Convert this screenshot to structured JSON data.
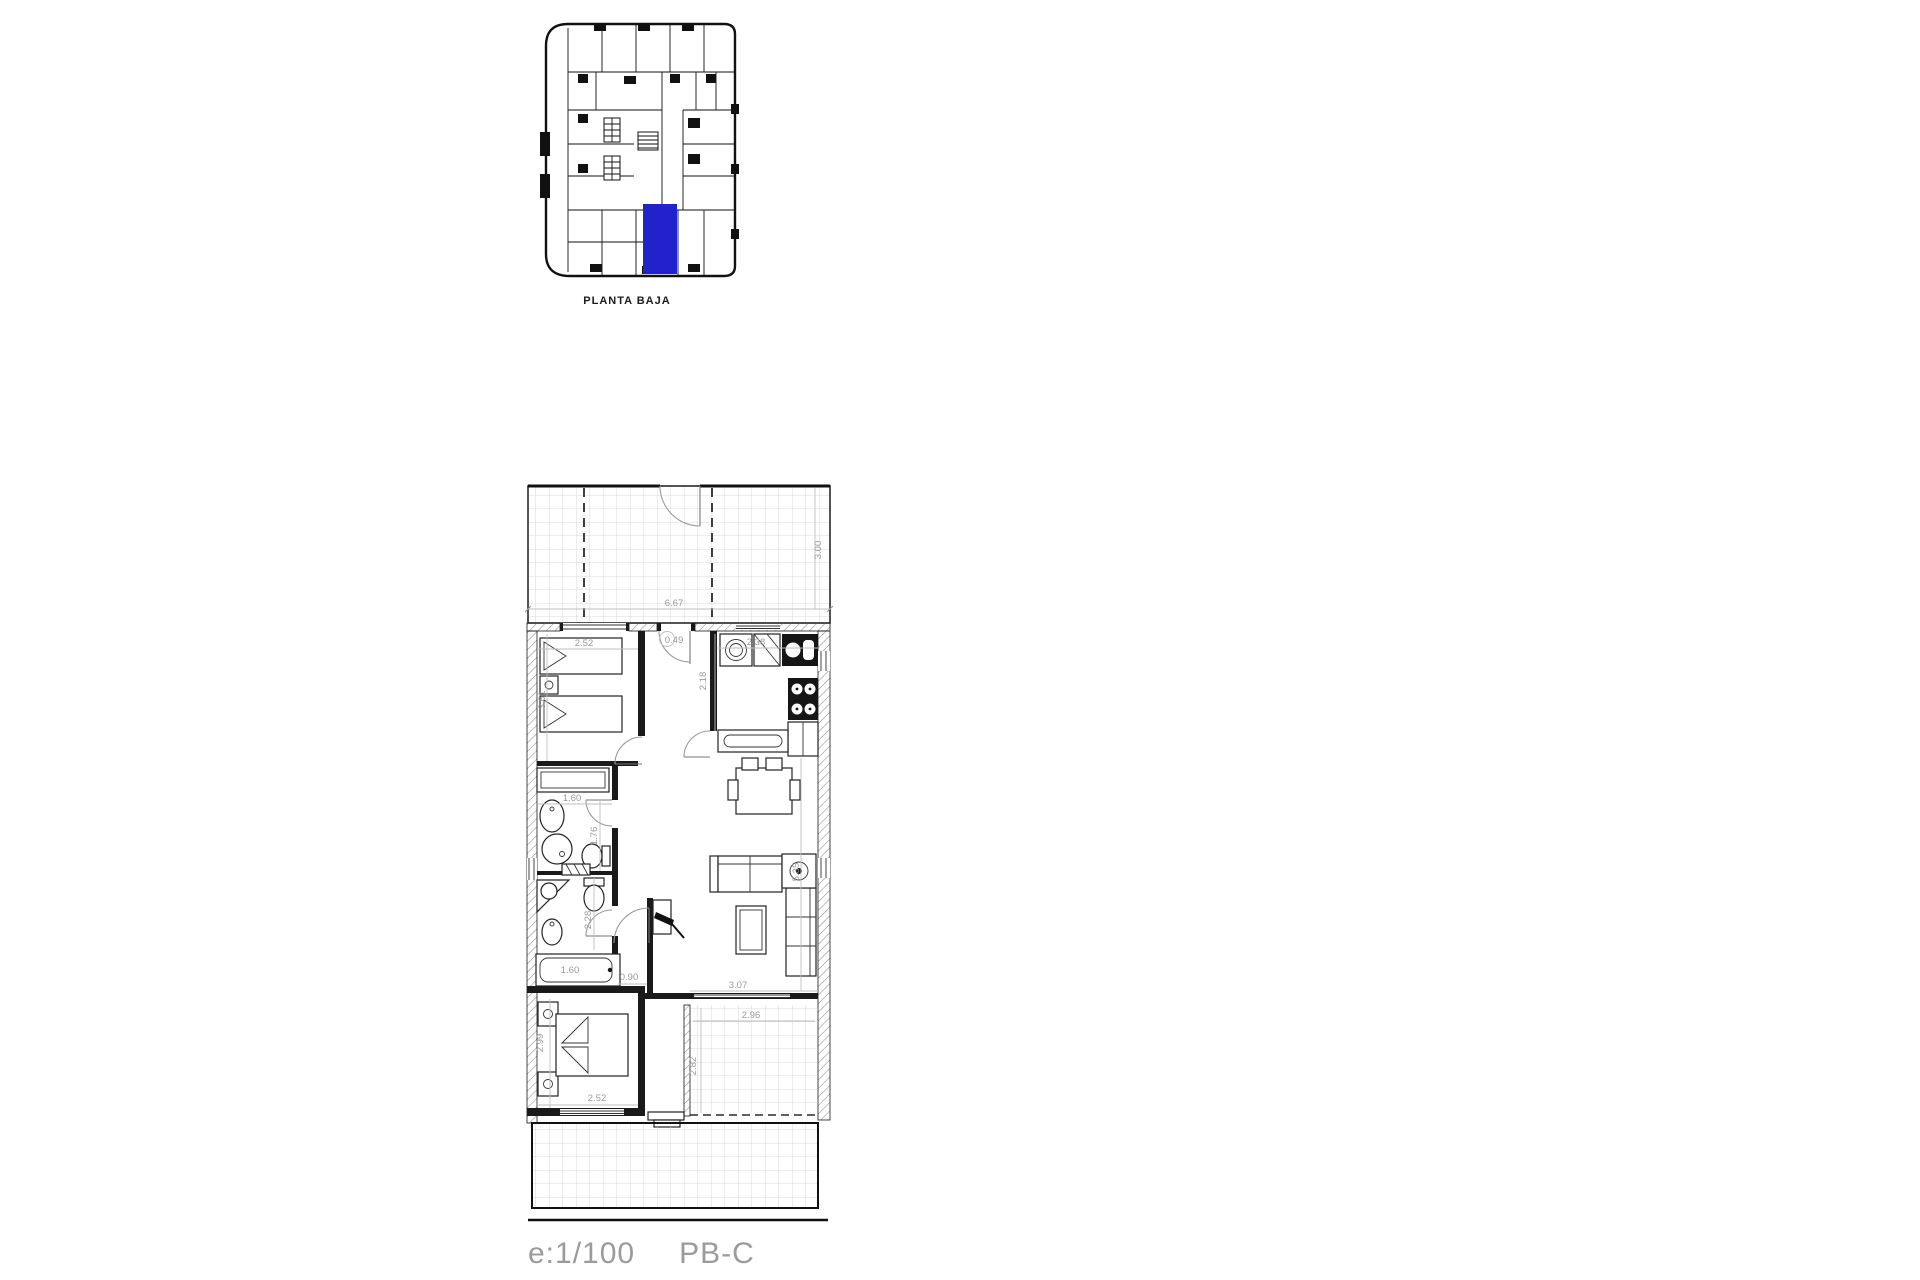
{
  "overview": {
    "caption": "PLANTA BAJA",
    "highlight_color": "#2222cd"
  },
  "plan": {
    "terrace_top": {
      "width": "6.67",
      "depth": "3.00"
    },
    "bedroom1": {
      "width": "2.52",
      "depth": "3.61"
    },
    "vanity": {
      "width": "1.60"
    },
    "hall": {
      "entry_width": "0.49",
      "bottom_width": "0.90"
    },
    "kitchen": {
      "width": "2.38",
      "depth": "2.18"
    },
    "bath1": {
      "depth": "1.76"
    },
    "bath2": {
      "depth": "2.28",
      "bathtub_length": "1.60"
    },
    "living": {
      "width": "3.07",
      "depth": "5.35"
    },
    "bedroom2": {
      "width": "2.52",
      "depth": "2.99"
    },
    "patio": {
      "width": "2.96",
      "depth": "2.82"
    }
  },
  "footer": {
    "scale": "e:1/100",
    "code": "PB-C"
  }
}
